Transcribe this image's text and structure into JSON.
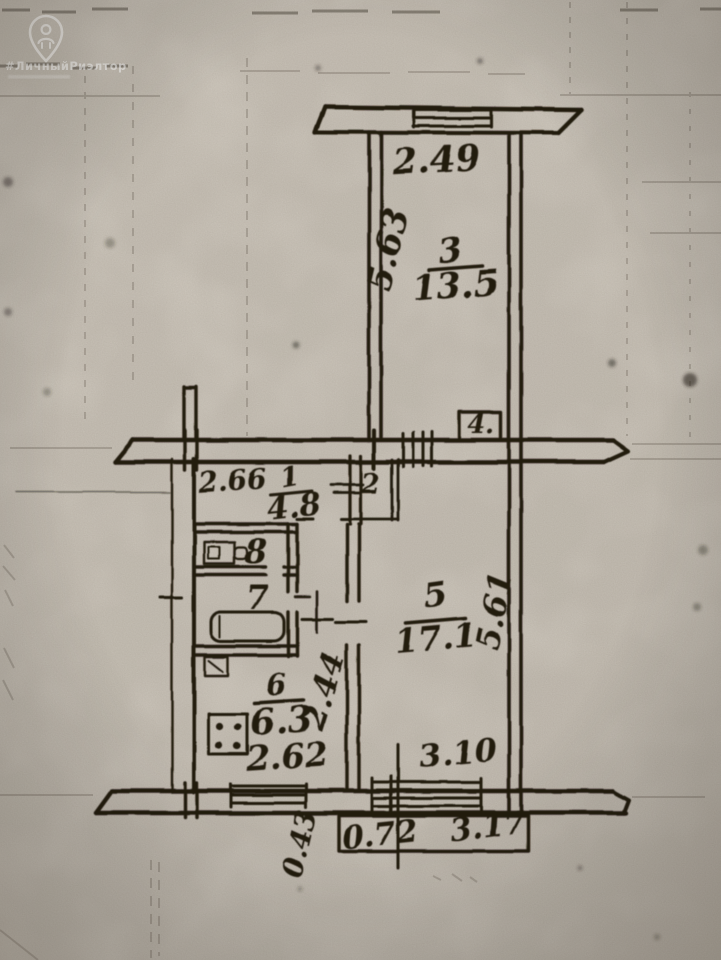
{
  "watermark": {
    "hashtag": "#ЛичныйРиэлтор"
  },
  "plan": {
    "balcony_top": {
      "width": "2.49"
    },
    "room3": {
      "number": "3",
      "area": "13.5",
      "depth": "5.63"
    },
    "closet4": {
      "number": "4."
    },
    "hall1": {
      "number": "1",
      "area": "4.8",
      "width": "2.66"
    },
    "closet2": {
      "number": "2"
    },
    "wc8": {
      "number": "8"
    },
    "bath7": {
      "number": "7"
    },
    "kitchen6": {
      "number": "6",
      "area": "6.3",
      "width": "2.62",
      "depth": "2.44"
    },
    "room5": {
      "number": "5",
      "area": "17.1",
      "depth": "5.61",
      "width": "3.10"
    },
    "balcony_bottom": {
      "offset": "0.43",
      "part": "0.72",
      "width": "3.17"
    }
  }
}
